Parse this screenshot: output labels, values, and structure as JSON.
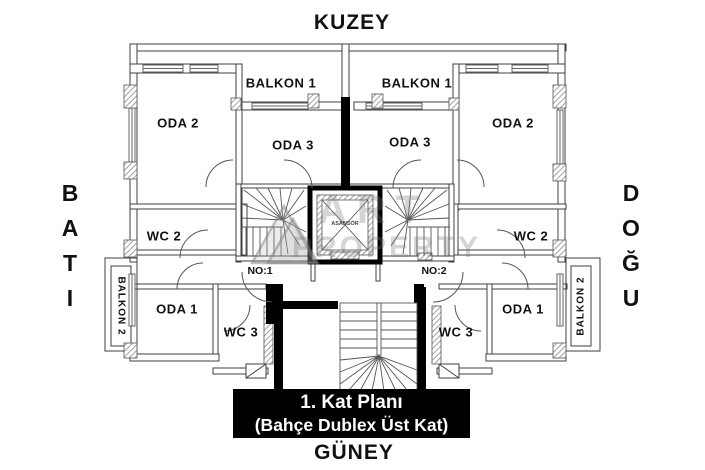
{
  "compass": {
    "north": "KUZEY",
    "south": "GÜNEY",
    "west": "BATI",
    "east": "DOĞU"
  },
  "plan": {
    "units": {
      "unit1": "NO:1",
      "unit2": "NO:2"
    },
    "elevator_label": "ASANSÖR",
    "rooms": {
      "balkon1_left": "BALKON 1",
      "balkon1_right": "BALKON 1",
      "oda2_left": "ODA 2",
      "oda2_right": "ODA 2",
      "oda3_left": "ODA 3",
      "oda3_right": "ODA 3",
      "wc2_left": "WC 2",
      "wc2_right": "WC 2",
      "oda1_left": "ODA 1",
      "oda1_right": "ODA 1",
      "wc3_left": "WC 3",
      "wc3_right": "WC 3",
      "balkon2_left": "BALKON 2",
      "balkon2_right": "BALKON 2"
    }
  },
  "title_block": {
    "line1": "1. Kat Planı",
    "line2": "(Bahçe Dublex Üst Kat)"
  },
  "watermark": {
    "line1": "ART",
    "line2": "PROPERTY"
  },
  "colors": {
    "wall_black": "#000000",
    "line": "#3f3f3f",
    "hatch": "#8a8a8a",
    "title_bg": "#000000",
    "title_fg": "#ffffff"
  }
}
